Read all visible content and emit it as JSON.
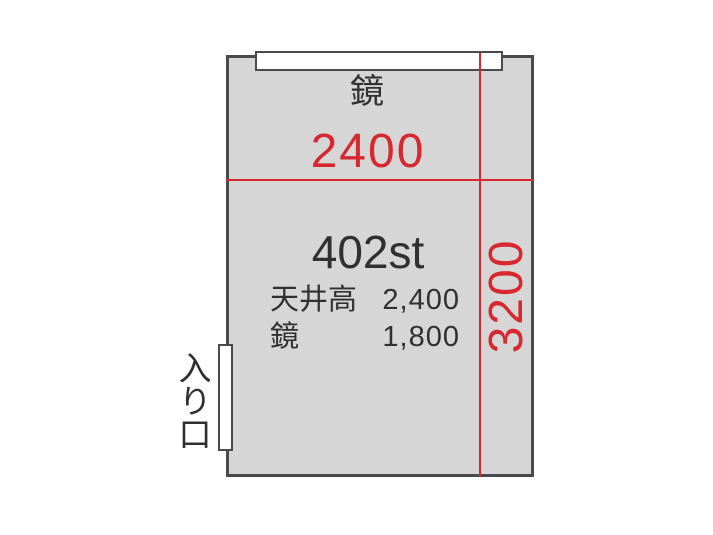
{
  "colors": {
    "red": "#d7282f",
    "wall": "#4a4a4a",
    "room_fill": "#d6d6d7",
    "text": "#303030"
  },
  "floorplan": {
    "room_id": "402st",
    "mirror_label": "鏡",
    "width_dimension": "2400",
    "height_dimension": "3200",
    "entrance_label": "入り口",
    "specs": [
      {
        "label": "天井高",
        "value": "2,400"
      },
      {
        "label": "鏡",
        "value": "1,800"
      }
    ]
  }
}
